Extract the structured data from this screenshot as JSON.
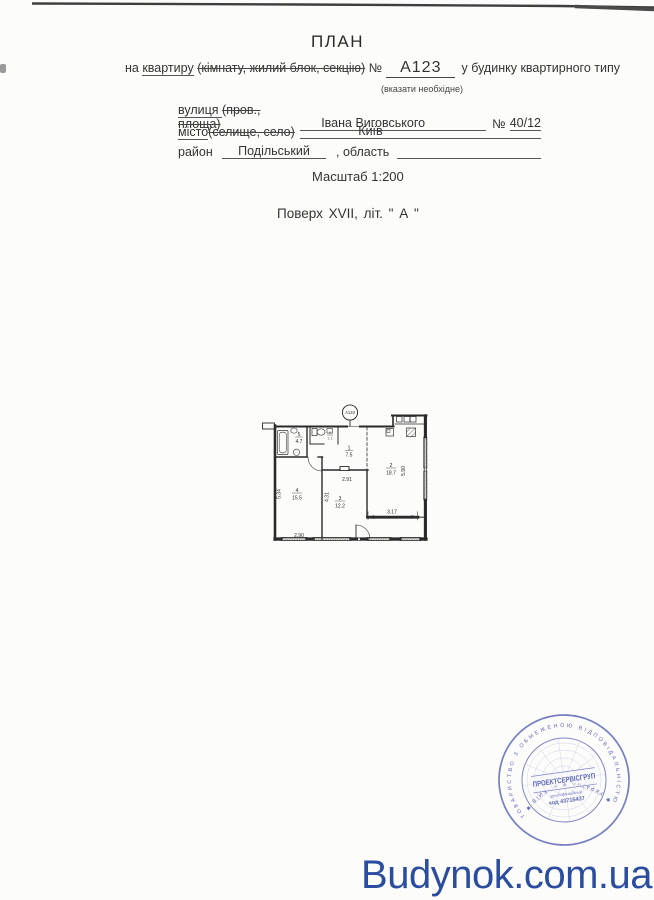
{
  "header": {
    "title": "ПЛАН",
    "prefix": "на ",
    "object_underlined": "квартиру",
    "object_struck": "(кімнату, жилий блок, секцію)",
    "number_sign": "№",
    "number": "А123",
    "suffix": "у будинку квартирного типу",
    "note": "(вказати необхідне)"
  },
  "form": {
    "street_label": "вулиця ",
    "street_struck": "(пров., площа)",
    "street_value": "Івана Виговського",
    "no_sign": "№",
    "street_no": "40/12",
    "city_label": "місто",
    "city_struck": "(селище, село)",
    "city_value": "Київ",
    "district_label": "район",
    "district_value": "Подільський",
    "oblast_label": ", область",
    "oblast_value": "",
    "scale": "Масштаб 1:200",
    "floor_line": "Поверх  XVII,   літ. \" А \""
  },
  "plan": {
    "badge": "А123",
    "rooms": [
      {
        "n": "1",
        "a": "7.5"
      },
      {
        "n": "2",
        "a": "18.7"
      },
      {
        "n": "3",
        "a": "12.2"
      },
      {
        "n": "4",
        "a": "15.5"
      },
      {
        "n": "5",
        "a": "4.7"
      },
      {
        "n": "6",
        "a": "1.1"
      }
    ],
    "dims": {
      "left": "5.34",
      "bottom_left": "2.90",
      "mid_v": "4.31",
      "mid_h": "2.91",
      "right_h": "3.17",
      "right_v": "5.90"
    }
  },
  "stamp": {
    "ring_top": "ТОВАРИСТВО З ОБМЕЖЕНОЮ ВІДПОВІДАЛЬНІСТЮ",
    "ring_bottom": "✱ УКРАЇНА ✱ м. КИЇВ ✱",
    "center": "ПРОЕКТСЕРВІСГРУП",
    "id_label": "ідентифікаційний",
    "id_code": "код 43715437"
  },
  "watermark": {
    "text": "Budynok.com.ua"
  },
  "colors": {
    "stamp_blue": "#4a53ae",
    "watermark_blue": "#2b4da0",
    "plan_ink": "#2a2a2a"
  }
}
